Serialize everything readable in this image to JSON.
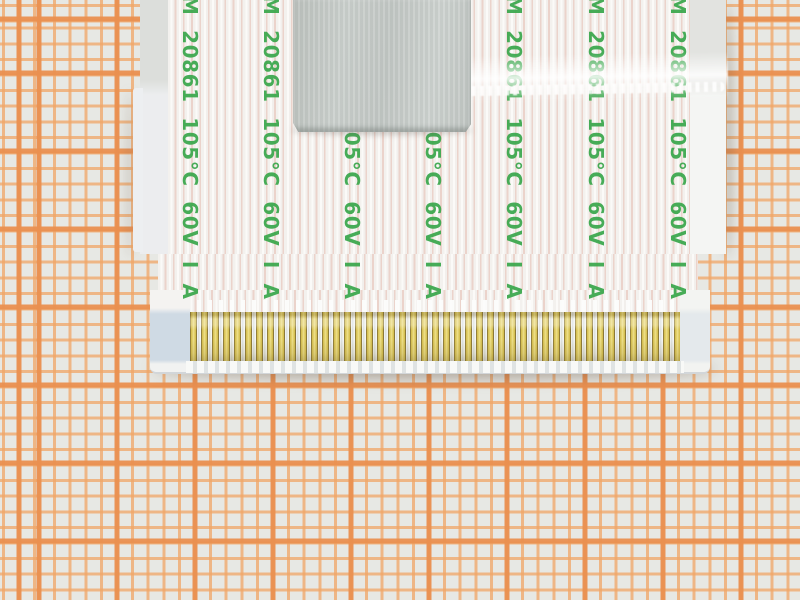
{
  "scene": {
    "description": "Macro photograph of a white flat flexible cable (FFC) end with gold-plated contacts and a silver foil tape patch, lying on orange millimeter graph paper"
  },
  "paper": {
    "kind": "millimeter graph paper",
    "background_color": "#e7e8e4",
    "thin_line_color": "#f1a666",
    "thick_line_color": "#ea9050",
    "small_square_px": 15.6,
    "thick_line_every_n_squares": 5
  },
  "cable": {
    "marking_text": "M 20861 105°C 60V I A",
    "marking_visible_repeat": "M 20861 105°C 60V I A M",
    "marking_color": "#3aa74c",
    "marking_columns": 7,
    "film_color": "#f4f2ef",
    "conductor_line_color": "#ebd3cb"
  },
  "tape": {
    "label": "silver foil tape patch",
    "color": "#c5cac6"
  },
  "contacts": {
    "count": 45,
    "pitch_px": 11,
    "gold_color": "#e3cf6a",
    "dark_edge_color": "#93803a"
  },
  "stiffener": {
    "left_pad_color": "#cfdae4",
    "right_pad_color": "#e4e9ec"
  }
}
